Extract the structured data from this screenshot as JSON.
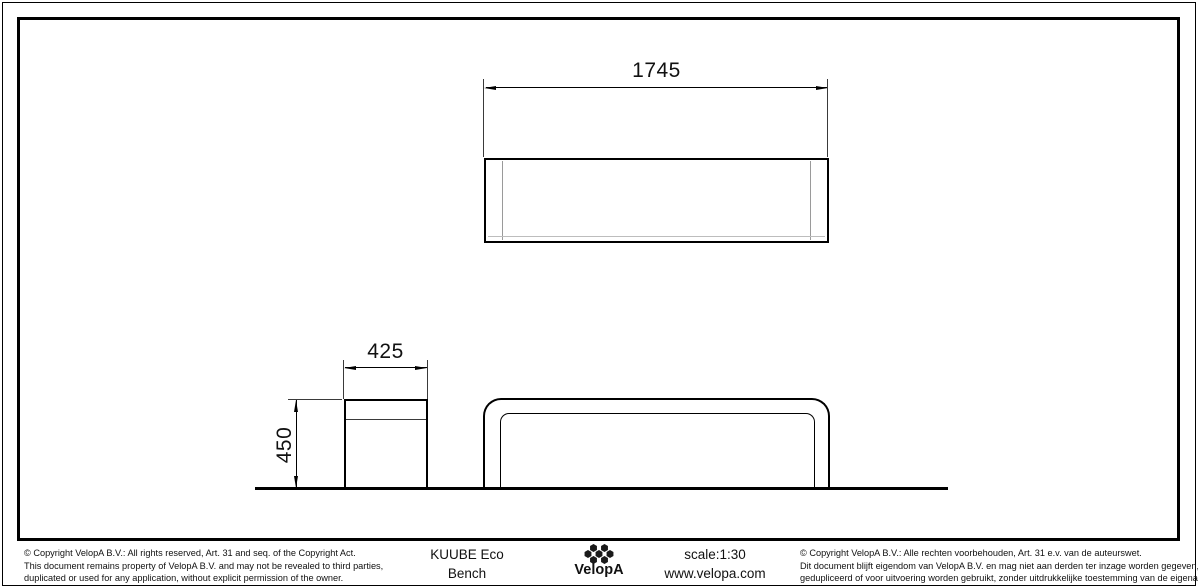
{
  "drawing": {
    "dimensions": {
      "length": "1745",
      "width": "425",
      "height": "450"
    }
  },
  "title_block": {
    "product": {
      "line1": "KUUBE Eco",
      "line2": "Bench"
    },
    "logo": {
      "text": "VelopA",
      "icon": "velopa-flower-icon"
    },
    "scale": "scale:1:30",
    "website": "www.velopa.com",
    "copyright_en": {
      "lines": [
        "©  Copyright VelopA B.V.: All rights reserved, Art. 31 and seq. of the Copyright Act.",
        "This document remains property of VelopA B.V. and may not be revealed to third parties,",
        "duplicated or used for any application, without explicit permission of the owner."
      ]
    },
    "copyright_nl": {
      "lines": [
        "©  Copyright VelopA B.V.: Alle rechten voorbehouden, Art. 31 e.v. van de auteurswet.",
        "Dit document blijft eigendom van VelopA B.V. en mag niet aan derden ter inzage worden gegeven,",
        "gedupliceerd of voor uitvoering worden gebruikt, zonder uitdrukkelijke toestemming van de eigenaar."
      ]
    }
  },
  "colors": {
    "background": "#ffffff",
    "line": "#000000",
    "thin_line": "#9a9a9a"
  }
}
